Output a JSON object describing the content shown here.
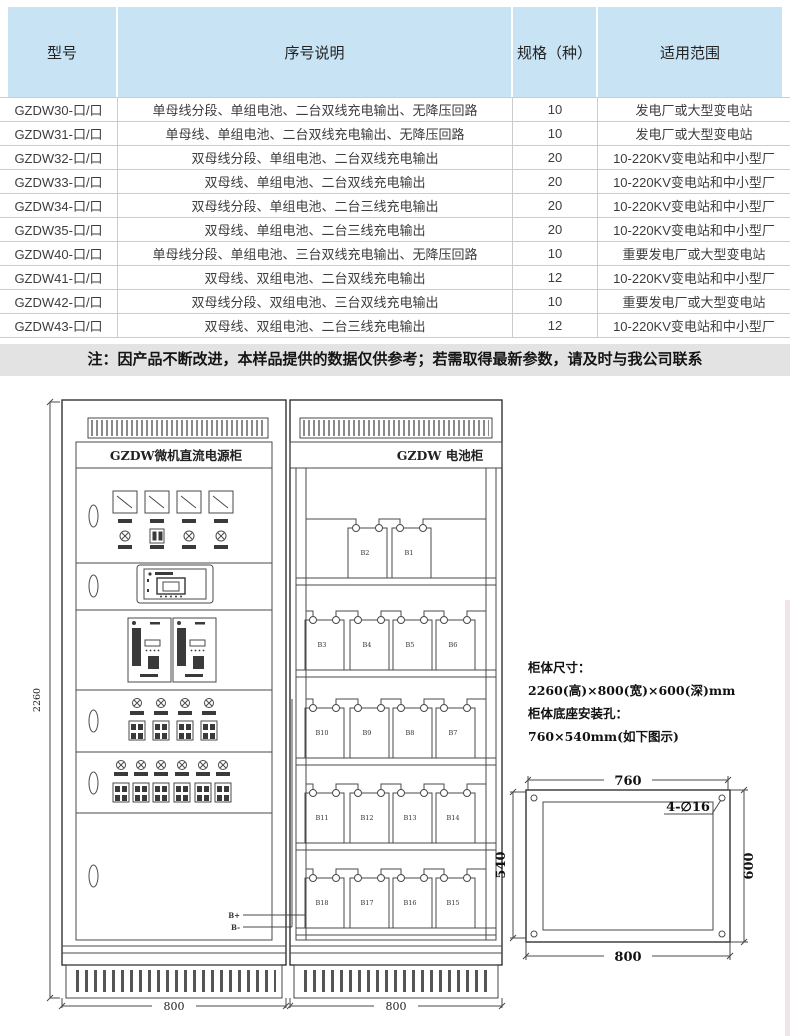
{
  "table": {
    "headers": [
      "型号",
      "序号说明",
      "规格（种）",
      "适用范围"
    ],
    "rows": [
      {
        "model": "GZDW30-口/口",
        "desc": "单母线分段、单组电池、二台双线充电输出、无降压回路",
        "spec": "10",
        "range": "发电厂或大型变电站"
      },
      {
        "model": "GZDW31-口/口",
        "desc": "单母线、单组电池、二台双线充电输出、无降压回路",
        "spec": "10",
        "range": "发电厂或大型变电站"
      },
      {
        "model": "GZDW32-口/口",
        "desc": "双母线分段、单组电池、二台双线充电输出",
        "spec": "20",
        "range": "10-220KV变电站和中小型厂"
      },
      {
        "model": "GZDW33-口/口",
        "desc": "双母线、单组电池、二台双线充电输出",
        "spec": "20",
        "range": "10-220KV变电站和中小型厂"
      },
      {
        "model": "GZDW34-口/口",
        "desc": "双母线分段、单组电池、二台三线充电输出",
        "spec": "20",
        "range": "10-220KV变电站和中小型厂"
      },
      {
        "model": "GZDW35-口/口",
        "desc": "双母线、单组电池、二台三线充电输出",
        "spec": "20",
        "range": "10-220KV变电站和中小型厂"
      },
      {
        "model": "GZDW40-口/口",
        "desc": "单母线分段、单组电池、三台双线充电输出、无降压回路",
        "spec": "10",
        "range": "重要发电厂或大型变电站"
      },
      {
        "model": "GZDW41-口/口",
        "desc": "双母线、双组电池、二台双线充电输出",
        "spec": "12",
        "range": "10-220KV变电站和中小型厂"
      },
      {
        "model": "GZDW42-口/口",
        "desc": "双母线分段、双组电池、三台双线充电输出",
        "spec": "10",
        "range": "重要发电厂或大型变电站"
      },
      {
        "model": "GZDW43-口/口",
        "desc": "双母线、双组电池、二台三线充电输出",
        "spec": "12",
        "range": "10-220KV变电站和中小型厂"
      }
    ]
  },
  "note": "注：因产品不断改进，本样品提供的数据仅供参考；若需取得最新参数，请及时与我公司联系",
  "diagram": {
    "left_cabinet_title": "GZDW微机直流电源柜",
    "right_cabinet_title": "GZDW 电池柜",
    "terminal_pos": "B+",
    "terminal_neg": "B-",
    "batteries": [
      "B2",
      "B1",
      "B3",
      "B4",
      "B5",
      "B6",
      "B10",
      "B9",
      "B8",
      "B7",
      "B11",
      "B12",
      "B13",
      "B14",
      "B18",
      "B17",
      "B16",
      "B15"
    ],
    "dims": {
      "cabinet_height": "2260",
      "left_cabinet_width": "800",
      "right_cabinet_width": "800"
    },
    "specs": {
      "line1": "柜体尺寸：",
      "line2": "2260(高)×800(宽)×600(深)mm",
      "line3": "柜体底座安装孔：",
      "line4": "760×540mm(如下图示)"
    },
    "mounting": {
      "top_dim": "760",
      "bottom_dim": "800",
      "left_dim": "540",
      "right_dim": "600",
      "holes_label": "4-∅16"
    }
  },
  "colors": {
    "header_bg": "#c8e4f4",
    "note_bg": "#e3e3e3",
    "line": "#4a4a4a",
    "border": "#cccccc"
  }
}
